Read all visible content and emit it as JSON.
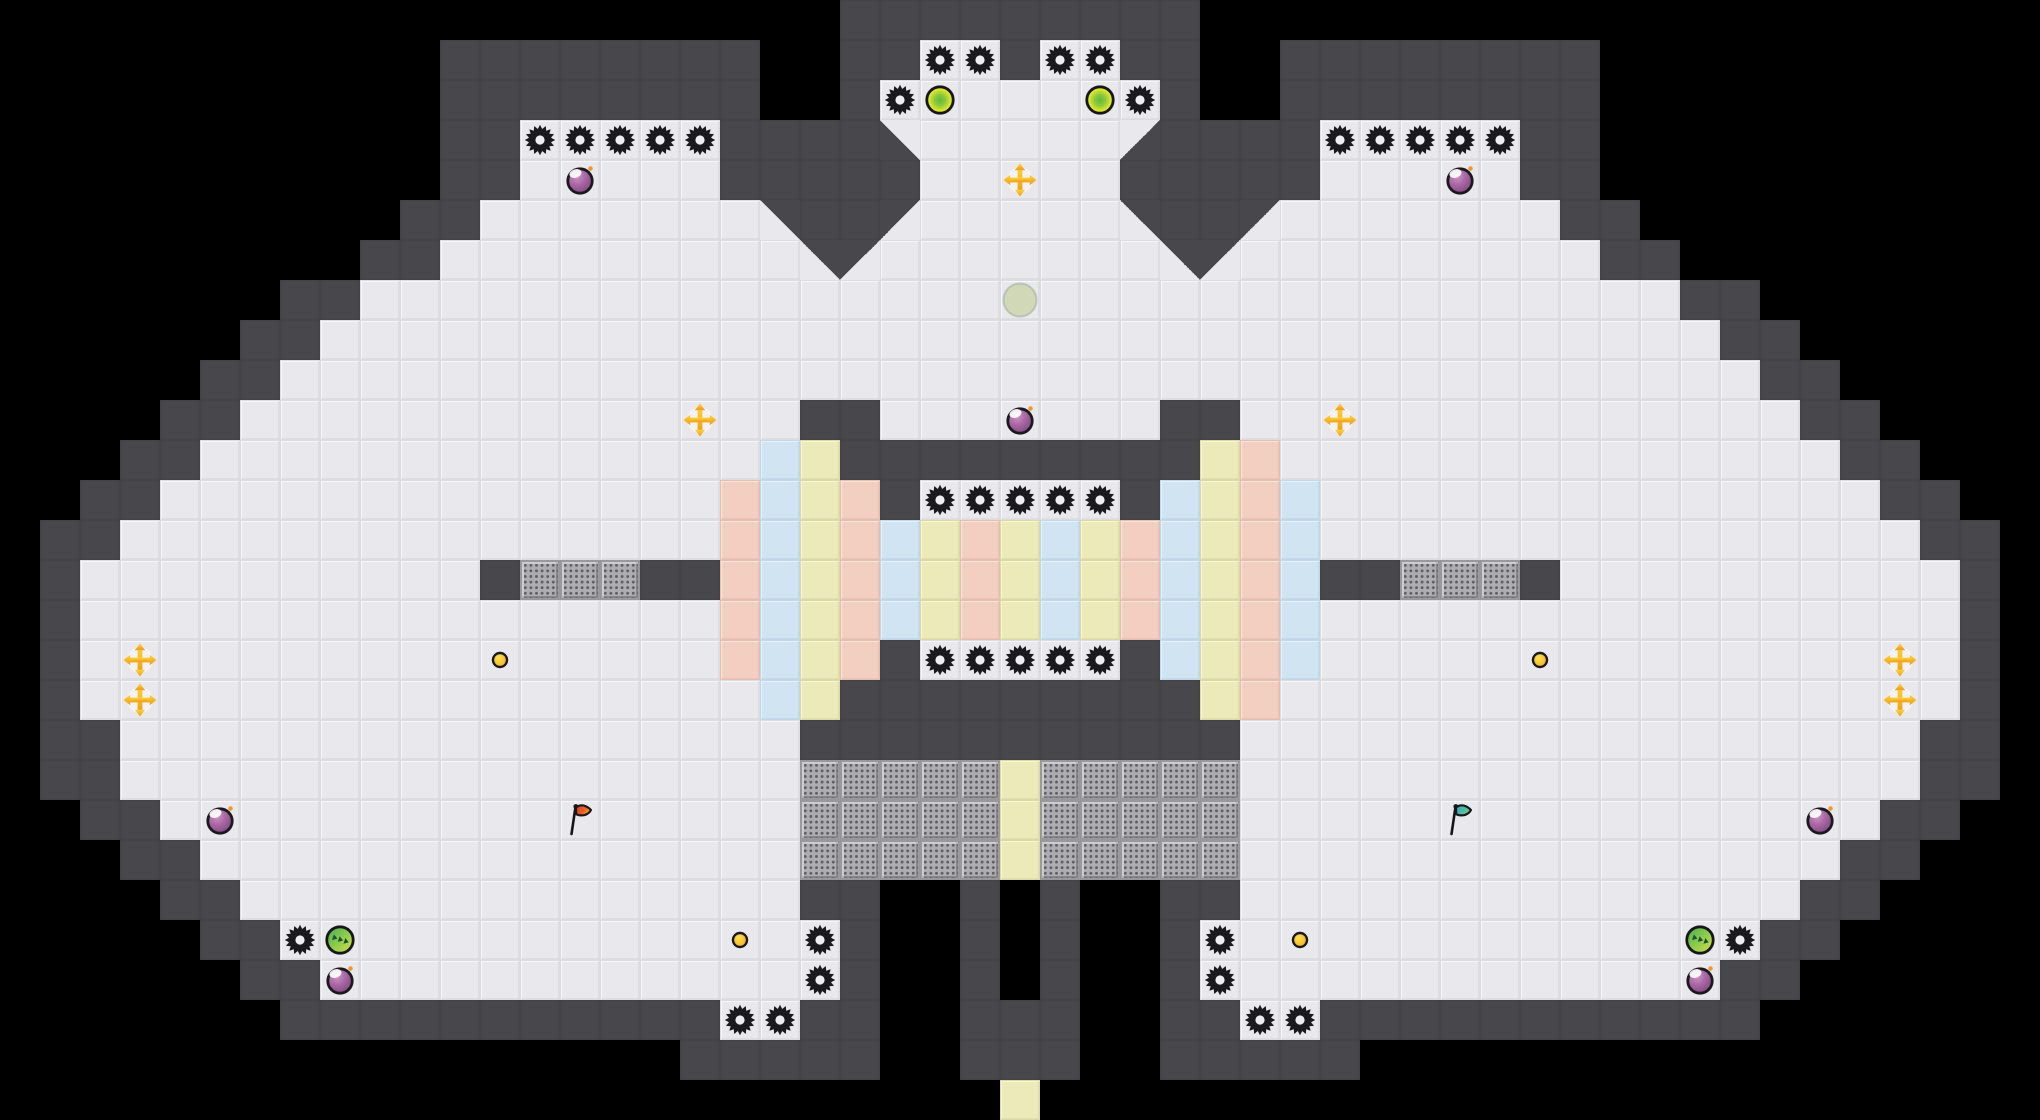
{
  "meta": {
    "tile_size": 40,
    "cols": 51,
    "rows": 28,
    "width_px": 2040,
    "height_px": 1120
  },
  "palette": {
    "void": "#000000",
    "wall": "#47474c",
    "floor": "#e9e9ed",
    "floor_edge": "#dbdbe1",
    "pink_block": "#f3cfc1",
    "blue_block": "#d0e4f2",
    "yellow_block": "#edeaba",
    "grate": "#aeaeb2",
    "grate_dot": "#5d5d63",
    "gear": "#1a1a1d",
    "gear_center": "#eeeef2",
    "bomb_purple": "#a867a4",
    "bomb_fuse": "#f2992e",
    "bounce_yellow": "#dde82e",
    "bounce_green": "#5fb843",
    "green_orb": "#8cca4c",
    "gold": "#f5b11c",
    "ghost": "#ccd6ae",
    "nugget": "#fdc722",
    "flag_red": "#e8432f",
    "flag_red_tip": "#f7a81b",
    "flag_teal": "#46aec6",
    "flag_teal_tip": "#6fd083",
    "exit_yellow": "#edeaba"
  },
  "legend": {
    "#": "void",
    "W": "wall-block",
    ".": "floor-tile",
    "P": "pink-block",
    "B": "blue-block",
    "Y": "yellow-block",
    "G": "grate-block",
    "q": "slope-wall-top-left",
    "e": "slope-wall-top-right",
    "z": "slope-wall-bottom-left",
    "c": "slope-wall-bottom-right"
  },
  "map_rows": [
    "#####################WWWWWWWWW#####################",
    "###########WWWWWWWW##WW..W..WW##WWWWWWWW###########",
    "###########WWWWWWWW##W.......W##WWWWWWWW###########",
    "###########WW.....WWWWz.....cWWWW.....WW###########",
    "###########WW.....WWWWW.....WWWWW.....WW###########",
    "##########WW.......eWWq.....eWWq.......WW##########",
    "#########WW.........eq.......eq.........WW#########",
    "#######WW.................................WW#######",
    "######WW...................................WW######",
    "#####WW.....................................WW#####",
    "####WW..............WW.......WW..............WW####",
    "###WW..............BYWWWWWWWWWYP..............WW###",
    "##WW..............PBYPW.....WBYPB..............WW##",
    "#WW...............PBYPBYPYBYPBYPB...............WW#",
    "#W..........WGGGWWPBYPBYPYBYPBYPBWWGGGW..........W#",
    "#W................PBYPBYPYBYPBYPB................W#",
    "#W................PBYPW.....WBYPB................W#",
    "#W.................BYWWWWWWWWWYP.................W#",
    "#WW.................WWWWWWWWWWW.................WW#",
    "#WW.................GGGGGYGGGGG.................WW#",
    "##WW................GGGGGYGGGGG................WW##",
    "###WW...............GGGGGYGGGGG...............WW###",
    "####WW..............WW##W#W##WW..............WW####",
    "#####WW..............W##W#W##W..............WW#####",
    "######WW.............W##W#W##W.............WW######",
    "#######WWWWWWWWWWW..WW##WWW##WW..WWWWWWWWWWW#######",
    "#################WWWWW##WWW##WWWWW#################",
    "#########################Y#########################"
  ],
  "objects": [
    {
      "type": "gear-mine",
      "col": 23,
      "row": 1
    },
    {
      "type": "gear-mine",
      "col": 24,
      "row": 1
    },
    {
      "type": "gear-mine",
      "col": 26,
      "row": 1
    },
    {
      "type": "gear-mine",
      "col": 27,
      "row": 1
    },
    {
      "type": "gear-mine",
      "col": 22,
      "row": 2
    },
    {
      "type": "gear-mine",
      "col": 28,
      "row": 2
    },
    {
      "type": "bounce-orb",
      "col": 23,
      "row": 2
    },
    {
      "type": "bounce-orb",
      "col": 27,
      "row": 2
    },
    {
      "type": "gear-mine",
      "col": 13,
      "row": 3
    },
    {
      "type": "gear-mine",
      "col": 14,
      "row": 3
    },
    {
      "type": "gear-mine",
      "col": 15,
      "row": 3
    },
    {
      "type": "gear-mine",
      "col": 16,
      "row": 3
    },
    {
      "type": "gear-mine",
      "col": 17,
      "row": 3
    },
    {
      "type": "gear-mine",
      "col": 33,
      "row": 3
    },
    {
      "type": "gear-mine",
      "col": 34,
      "row": 3
    },
    {
      "type": "gear-mine",
      "col": 35,
      "row": 3
    },
    {
      "type": "gear-mine",
      "col": 36,
      "row": 3
    },
    {
      "type": "gear-mine",
      "col": 37,
      "row": 3
    },
    {
      "type": "purple-bomb",
      "col": 14,
      "row": 4
    },
    {
      "type": "purple-bomb",
      "col": 36,
      "row": 4
    },
    {
      "type": "gold-cross",
      "col": 25,
      "row": 4
    },
    {
      "type": "ghost-orb",
      "col": 25,
      "row": 7
    },
    {
      "type": "gold-cross",
      "col": 17,
      "row": 10
    },
    {
      "type": "gold-cross",
      "col": 33,
      "row": 10
    },
    {
      "type": "purple-bomb",
      "col": 25,
      "row": 10
    },
    {
      "type": "gear-mine",
      "col": 23,
      "row": 12
    },
    {
      "type": "gear-mine",
      "col": 24,
      "row": 12
    },
    {
      "type": "gear-mine",
      "col": 25,
      "row": 12
    },
    {
      "type": "gear-mine",
      "col": 26,
      "row": 12
    },
    {
      "type": "gear-mine",
      "col": 27,
      "row": 12
    },
    {
      "type": "gear-mine",
      "col": 23,
      "row": 16
    },
    {
      "type": "gear-mine",
      "col": 24,
      "row": 16
    },
    {
      "type": "gear-mine",
      "col": 25,
      "row": 16
    },
    {
      "type": "gear-mine",
      "col": 26,
      "row": 16
    },
    {
      "type": "gear-mine",
      "col": 27,
      "row": 16
    },
    {
      "type": "gold-cross",
      "col": 3,
      "row": 16
    },
    {
      "type": "gold-cross",
      "col": 3,
      "row": 17
    },
    {
      "type": "gold-cross",
      "col": 47,
      "row": 16
    },
    {
      "type": "gold-cross",
      "col": 47,
      "row": 17
    },
    {
      "type": "gold-nugget",
      "col": 12,
      "row": 16
    },
    {
      "type": "gold-nugget",
      "col": 38,
      "row": 16
    },
    {
      "type": "purple-bomb",
      "col": 5,
      "row": 20
    },
    {
      "type": "purple-bomb",
      "col": 45,
      "row": 20
    },
    {
      "type": "red-flag",
      "col": 14,
      "row": 20
    },
    {
      "type": "teal-flag",
      "col": 36,
      "row": 20
    },
    {
      "type": "gear-mine",
      "col": 7,
      "row": 23
    },
    {
      "type": "green-striped-orb",
      "col": 8,
      "row": 23
    },
    {
      "type": "purple-bomb",
      "col": 8,
      "row": 24
    },
    {
      "type": "gold-nugget",
      "col": 18,
      "row": 23
    },
    {
      "type": "gold-nugget",
      "col": 32,
      "row": 23
    },
    {
      "type": "gear-mine",
      "col": 20,
      "row": 23
    },
    {
      "type": "gear-mine",
      "col": 20,
      "row": 24
    },
    {
      "type": "gear-mine",
      "col": 30,
      "row": 23
    },
    {
      "type": "gear-mine",
      "col": 30,
      "row": 24
    },
    {
      "type": "gear-mine",
      "col": 18,
      "row": 25
    },
    {
      "type": "gear-mine",
      "col": 19,
      "row": 25
    },
    {
      "type": "gear-mine",
      "col": 31,
      "row": 25
    },
    {
      "type": "gear-mine",
      "col": 32,
      "row": 25
    },
    {
      "type": "green-striped-orb",
      "col": 42,
      "row": 23
    },
    {
      "type": "gear-mine",
      "col": 43,
      "row": 23
    },
    {
      "type": "purple-bomb",
      "col": 42,
      "row": 24
    }
  ]
}
